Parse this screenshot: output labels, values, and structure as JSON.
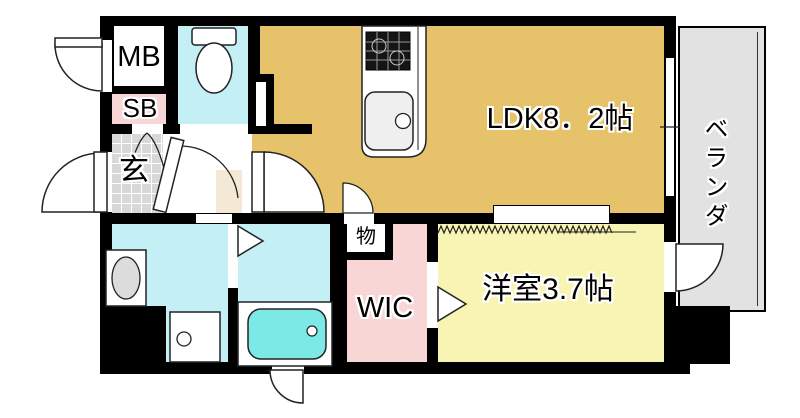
{
  "floorplan": {
    "rooms": {
      "mb": "MB",
      "sb": "SB",
      "genkan": "玄",
      "ldk": "LDK8．2帖",
      "veranda": "ベランダ",
      "storage": "物",
      "wic": "WIC",
      "western": "洋室3.7帖"
    },
    "colors": {
      "wall": "#000000",
      "ldk_floor": "#e6c36b",
      "western_floor": "#f8f5b4",
      "wic_floor": "#f9d6d6",
      "sb_box": "#f9d6d6",
      "wet_rooms": "#c4f0f5",
      "bathtub_water": "#7de9e6",
      "veranda_floor": "#e2e2e2",
      "genkan_tile": "#d8d8d8",
      "hall_accent": "#f3e9d4"
    }
  }
}
